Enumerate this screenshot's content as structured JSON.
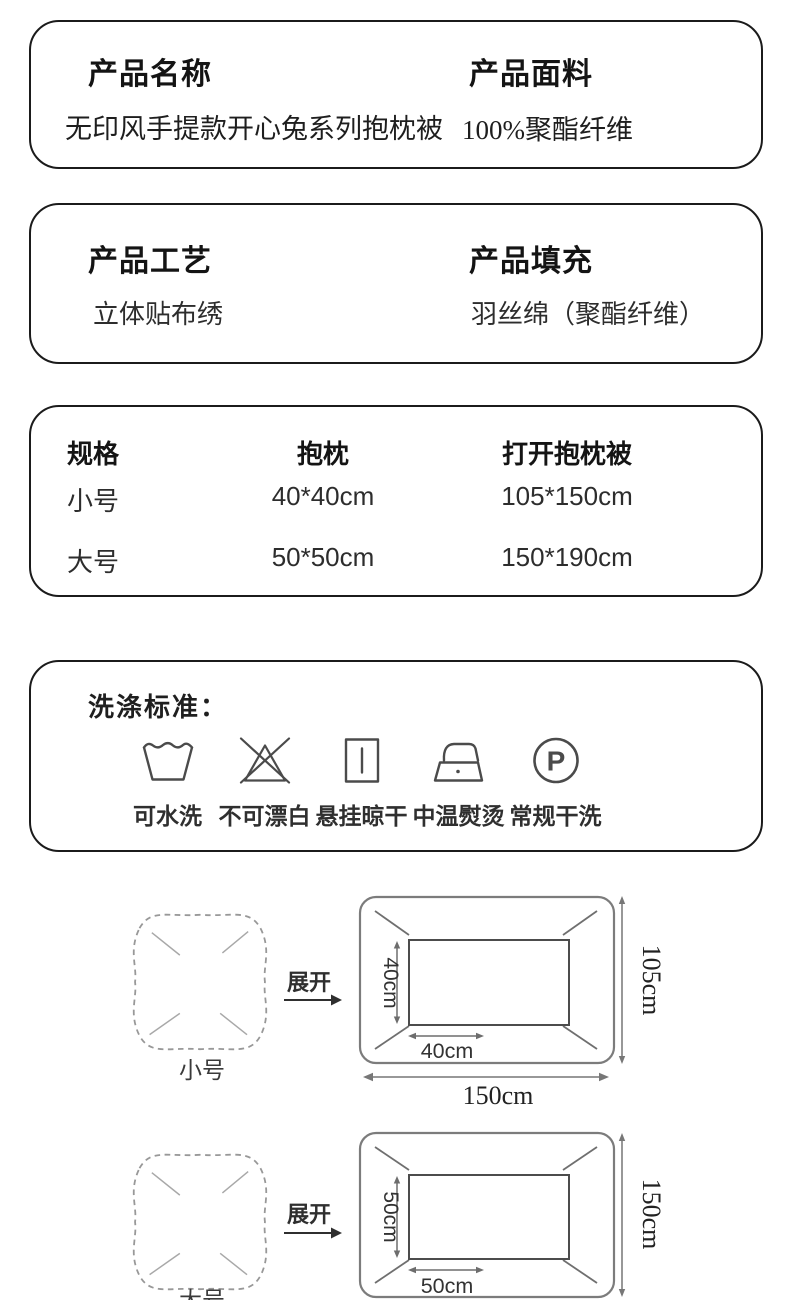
{
  "colors": {
    "ink": "#1b1b1b",
    "diagram_line": "#7c7c7c",
    "icon_stroke": "#4b4b4b"
  },
  "cards": [
    {
      "columns": [
        {
          "label": "产品名称",
          "value": "无印风手提款开心兔系列抱枕被"
        },
        {
          "label": "产品面料",
          "value": "100%聚酯纤维"
        }
      ]
    },
    {
      "columns": [
        {
          "label": "产品工艺",
          "value": "立体贴布绣"
        },
        {
          "label": "产品填充",
          "value": "羽丝绵（聚酯纤维）"
        }
      ]
    }
  ],
  "spec_table": {
    "headers": [
      "规格",
      "抱枕",
      "打开抱枕被"
    ],
    "rows": [
      [
        "小号",
        "40*40cm",
        "105*150cm"
      ],
      [
        "大号",
        "50*50cm",
        "150*190cm"
      ]
    ]
  },
  "washing": {
    "title": "洗涤标准：",
    "items": [
      {
        "icon": "wash-tub-icon",
        "label": "可水洗"
      },
      {
        "icon": "no-bleach-icon",
        "label": "不可漂白"
      },
      {
        "icon": "hang-dry-icon",
        "label": "悬挂晾干"
      },
      {
        "icon": "iron-medium-icon",
        "label": "中温熨烫"
      },
      {
        "icon": "dry-clean-icon",
        "label": "常规干洗",
        "symbol": "P"
      }
    ]
  },
  "diagrams": [
    {
      "pillow_label": "小号",
      "arrow_label": "展开",
      "inner_height_label": "40cm",
      "inner_width_label": "40cm",
      "outer_width_label": "150cm",
      "outer_height_label": "105cm"
    },
    {
      "pillow_label": "大号",
      "arrow_label": "展开",
      "inner_height_label": "50cm",
      "inner_width_label": "50cm",
      "outer_height_label": "150cm"
    }
  ]
}
